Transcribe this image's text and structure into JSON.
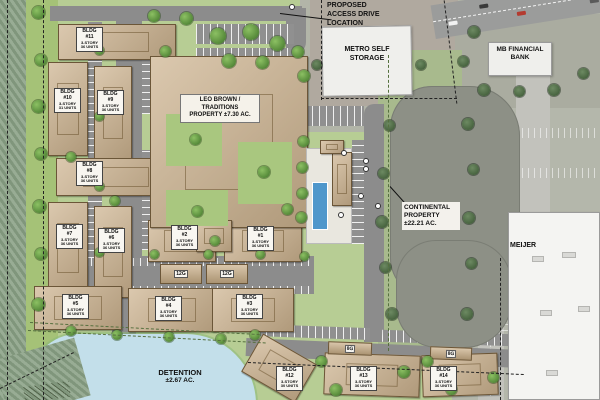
{
  "labels": {
    "proposed_access": {
      "l1": "PROPOSED",
      "l2": "ACCESS DRIVE",
      "l3": "LOCATION"
    },
    "metro_storage": {
      "l1": "METRO SELF",
      "l2": "STORAGE"
    },
    "mb_bank": {
      "l1": "MB FINANCIAL",
      "l2": "BANK"
    },
    "leo_brown": {
      "l1": "LEO BROWN /",
      "l2": "TRADITIONS",
      "l3": "PROPERTY ±7.30 AC."
    },
    "continental": {
      "l1": "CONTINENTAL",
      "l2": "PROPERTY",
      "l3": "±22.21 AC."
    },
    "meijer": "MEIJER",
    "detention": {
      "l1": "DETENTION",
      "l2": "±2.67 AC."
    }
  },
  "buildings": {
    "b1": {
      "l1": "BLDG",
      "l2": "#1",
      "l3": "3-STORY",
      "l4": "36 UNITS"
    },
    "b2": {
      "l1": "BLDG",
      "l2": "#2",
      "l3": "3-STORY",
      "l4": "36 UNITS"
    },
    "b3": {
      "l1": "BLDG",
      "l2": "#3",
      "l3": "3-STORY",
      "l4": "36 UNITS"
    },
    "b4": {
      "l1": "BLDG",
      "l2": "#4",
      "l3": "3-STORY",
      "l4": "36 UNITS"
    },
    "b5": {
      "l1": "BLDG",
      "l2": "#5",
      "l3": "3-STORY",
      "l4": "36 UNITS"
    },
    "b6": {
      "l1": "BLDG",
      "l2": "#6",
      "l3": "3-STORY",
      "l4": "36 UNITS"
    },
    "b7": {
      "l1": "BLDG",
      "l2": "#7",
      "l3": "3-STORY",
      "l4": "36 UNITS"
    },
    "b8": {
      "l1": "BLDG",
      "l2": "#8",
      "l3": "3-STORY",
      "l4": "36 UNITS"
    },
    "b9": {
      "l1": "BLDG",
      "l2": "#9",
      "l3": "3-STORY",
      "l4": "36 UNITS"
    },
    "b10": {
      "l1": "BLDG",
      "l2": "#10",
      "l3": "3-STORY",
      "l4": "31 UNITS"
    },
    "b11": {
      "l1": "BLDG",
      "l2": "#11",
      "l3": "3-STORY",
      "l4": "36 UNITS"
    },
    "b12": {
      "l1": "BLDG",
      "l2": "#12",
      "l3": "3-STORY",
      "l4": "30 UNITS"
    },
    "b13": {
      "l1": "BLDG",
      "l2": "#13",
      "l3": "3-STORY",
      "l4": "36 UNITS"
    },
    "b14": {
      "l1": "BLDG",
      "l2": "#14",
      "l3": "3-STORY",
      "l4": "36 UNITS"
    }
  },
  "garages": {
    "g1": "12G",
    "g2": "12G",
    "g3": "8G",
    "g4": "8G"
  },
  "colors": {
    "plan_grass": "#b7cd94",
    "road_gray": "#8c8c8c",
    "building_tan": "#cdb38f",
    "detention_blue": "#c3dfea",
    "pond_gray": "#8d9086",
    "aerial_gray": "#b2b5a8",
    "pool_blue": "#4f97cb"
  }
}
